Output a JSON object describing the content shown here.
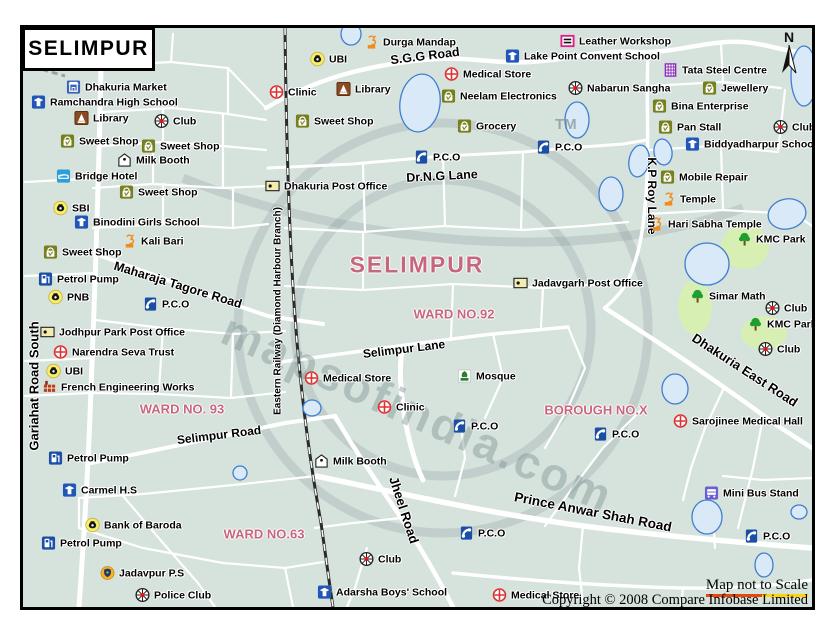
{
  "title": "SELIMPUR",
  "north_label": "N",
  "watermark": {
    "text": "mapsofindia.com",
    "tm": "TM"
  },
  "footer": {
    "scale_note": "Map not to Scale",
    "copyright": "Copyright © 2008 Compare Infobase Limited"
  },
  "colors": {
    "land": "#d6e2dc",
    "road": "#ffffff",
    "water_fill": "#d9e9f7",
    "water_stroke": "#3f7fd0",
    "park": "#d7efb2",
    "area_label": "#c7677e",
    "railway": "#2b2b2b"
  },
  "area_labels": [
    {
      "text": "SELIMPUR",
      "x": 394,
      "y": 237,
      "size": 23,
      "spacing": 2
    },
    {
      "text": "WARD NO.92",
      "x": 431,
      "y": 286,
      "size": 13,
      "spacing": 0
    },
    {
      "text": "WARD NO. 93",
      "x": 159,
      "y": 381,
      "size": 13,
      "spacing": 0
    },
    {
      "text": "WARD NO.63",
      "x": 241,
      "y": 506,
      "size": 13,
      "spacing": 0
    },
    {
      "text": "BOROUGH NO.X",
      "x": 573,
      "y": 382,
      "size": 13,
      "spacing": 0
    }
  ],
  "road_labels": [
    {
      "text": "S.G.G Road",
      "x": 402,
      "y": 28,
      "rot": -7,
      "size": 12.5
    },
    {
      "text": "Dr.N.G Lane",
      "x": 419,
      "y": 148,
      "rot": -3,
      "size": 12.5
    },
    {
      "text": "Maharaja Tagore Road",
      "x": 155,
      "y": 257,
      "rot": 17,
      "size": 12.5
    },
    {
      "text": "Selimpur Lane",
      "x": 381,
      "y": 321,
      "rot": -7,
      "size": 12
    },
    {
      "text": "Selimpur Road",
      "x": 196,
      "y": 407,
      "rot": -7,
      "size": 12
    },
    {
      "text": "Gariahat Road South",
      "x": 11,
      "y": 358,
      "rot": -90,
      "size": 13
    },
    {
      "text": "Eastern Railway (Diamond Harbour Branch)",
      "x": 255,
      "y": 283,
      "rot": -90,
      "size": 10
    },
    {
      "text": "K.P Roy Lane",
      "x": 629,
      "y": 168,
      "rot": 90,
      "size": 12
    },
    {
      "text": "Dhakuria East Road",
      "x": 722,
      "y": 342,
      "rot": 33,
      "size": 13
    },
    {
      "text": "Jheel Road",
      "x": 381,
      "y": 482,
      "rot": 72,
      "size": 13
    },
    {
      "text": "Prince Anwar Shah Road",
      "x": 570,
      "y": 484,
      "rot": 11,
      "size": 13.5
    }
  ],
  "pois": [
    {
      "label": "Dhakuria Market",
      "icon": "market",
      "x": 51,
      "y": 59
    },
    {
      "label": "Ramchandra High School",
      "icon": "school",
      "x": 16,
      "y": 74
    },
    {
      "label": "Library",
      "icon": "library",
      "x": 59,
      "y": 90
    },
    {
      "label": "Club",
      "icon": "club",
      "x": 139,
      "y": 93
    },
    {
      "label": "Sweet Shop",
      "icon": "shop",
      "x": 45,
      "y": 113
    },
    {
      "label": "Sweet Shop",
      "icon": "shop",
      "x": 126,
      "y": 118
    },
    {
      "label": "Milk Booth",
      "icon": "milk",
      "x": 102,
      "y": 132
    },
    {
      "label": "Bridge Hotel",
      "icon": "hotel",
      "x": 41,
      "y": 148
    },
    {
      "label": "Sweet Shop",
      "icon": "shop",
      "x": 104,
      "y": 164
    },
    {
      "label": "SBI",
      "icon": "bank",
      "x": 38,
      "y": 180
    },
    {
      "label": "Binodini Girls School",
      "icon": "school",
      "x": 59,
      "y": 194
    },
    {
      "label": "Kali Bari",
      "icon": "temple",
      "x": 107,
      "y": 213
    },
    {
      "label": "Sweet Shop",
      "icon": "shop",
      "x": 28,
      "y": 224
    },
    {
      "label": "Petrol Pump",
      "icon": "petrol",
      "x": 23,
      "y": 251
    },
    {
      "label": "PNB",
      "icon": "bank",
      "x": 33,
      "y": 269
    },
    {
      "label": "P.C.O",
      "icon": "pco",
      "x": 128,
      "y": 276
    },
    {
      "label": "Jodhpur Park Post Office",
      "icon": "post",
      "x": 25,
      "y": 304
    },
    {
      "label": "Narendra Seva Trust",
      "icon": "medical",
      "x": 38,
      "y": 324
    },
    {
      "label": "UBI",
      "icon": "bank",
      "x": 31,
      "y": 343
    },
    {
      "label": "French Engineering Works",
      "icon": "factory",
      "x": 27,
      "y": 359
    },
    {
      "label": "Petrol Pump",
      "icon": "petrol",
      "x": 33,
      "y": 430
    },
    {
      "label": "Carmel H.S",
      "icon": "school",
      "x": 47,
      "y": 462
    },
    {
      "label": "Bank of Baroda",
      "icon": "bank",
      "x": 70,
      "y": 497
    },
    {
      "label": "Petrol Pump",
      "icon": "petrol",
      "x": 26,
      "y": 515
    },
    {
      "label": "Jadavpur P.S",
      "icon": "police",
      "x": 85,
      "y": 545
    },
    {
      "label": "Police Club",
      "icon": "club",
      "x": 120,
      "y": 567
    },
    {
      "label": "Clinic",
      "icon": "medical",
      "x": 254,
      "y": 64
    },
    {
      "label": "Dhakuria Post Office",
      "icon": "post",
      "x": 250,
      "y": 158
    },
    {
      "label": "UBI",
      "icon": "bank",
      "x": 295,
      "y": 31
    },
    {
      "label": "Durga Mandap",
      "icon": "temple",
      "x": 349,
      "y": 14
    },
    {
      "label": "Library",
      "icon": "library",
      "x": 321,
      "y": 61
    },
    {
      "label": "Sweet Shop",
      "icon": "shop",
      "x": 280,
      "y": 93
    },
    {
      "label": "Medical Store",
      "icon": "medical",
      "x": 429,
      "y": 46
    },
    {
      "label": "Neelam Electronics",
      "icon": "shop",
      "x": 426,
      "y": 68
    },
    {
      "label": "Grocery",
      "icon": "shop",
      "x": 442,
      "y": 98
    },
    {
      "label": "P.C.O",
      "icon": "pco",
      "x": 399,
      "y": 129
    },
    {
      "label": "P.C.O",
      "icon": "pco",
      "x": 521,
      "y": 119
    },
    {
      "label": "Leather Workshop",
      "icon": "leather",
      "x": 545,
      "y": 13
    },
    {
      "label": "Lake Point Convent School",
      "icon": "school",
      "x": 490,
      "y": 28
    },
    {
      "label": "Tata Steel Centre",
      "icon": "steel",
      "x": 648,
      "y": 42
    },
    {
      "label": "Nabarun Sangha",
      "icon": "club",
      "x": 553,
      "y": 60
    },
    {
      "label": "Jewellery",
      "icon": "shop",
      "x": 687,
      "y": 60
    },
    {
      "label": "Bina Enterprise",
      "icon": "shop",
      "x": 637,
      "y": 78
    },
    {
      "label": "Pan Stall",
      "icon": "shop",
      "x": 643,
      "y": 99
    },
    {
      "label": "Club",
      "icon": "club",
      "x": 758,
      "y": 99
    },
    {
      "label": "Biddyadharpur School",
      "icon": "school",
      "x": 670,
      "y": 116
    },
    {
      "label": "Mobile Repair",
      "icon": "shop",
      "x": 645,
      "y": 149
    },
    {
      "label": "Temple",
      "icon": "temple",
      "x": 646,
      "y": 171
    },
    {
      "label": "Hari Sabha Temple",
      "icon": "temple",
      "x": 634,
      "y": 196
    },
    {
      "label": "KMC Park",
      "icon": "tree",
      "x": 722,
      "y": 211
    },
    {
      "label": "Jadavgarh Post Office",
      "icon": "post",
      "x": 498,
      "y": 255
    },
    {
      "label": "Simar Math",
      "icon": "tree",
      "x": 675,
      "y": 268
    },
    {
      "label": "Club",
      "icon": "club",
      "x": 750,
      "y": 280
    },
    {
      "label": "KMC Park",
      "icon": "tree",
      "x": 733,
      "y": 296
    },
    {
      "label": "Club",
      "icon": "club",
      "x": 743,
      "y": 321
    },
    {
      "label": "Medical Store",
      "icon": "medical",
      "x": 289,
      "y": 350
    },
    {
      "label": "Mosque",
      "icon": "mosque",
      "x": 442,
      "y": 348
    },
    {
      "label": "Clinic",
      "icon": "medical",
      "x": 362,
      "y": 379
    },
    {
      "label": "P.C.O",
      "icon": "pco",
      "x": 437,
      "y": 398
    },
    {
      "label": "P.C.O",
      "icon": "pco",
      "x": 578,
      "y": 406
    },
    {
      "label": "Sarojinee Medical Hall",
      "icon": "medical",
      "x": 658,
      "y": 393
    },
    {
      "label": "Milk Booth",
      "icon": "milk",
      "x": 299,
      "y": 433
    },
    {
      "label": "Mini Bus Stand",
      "icon": "bus",
      "x": 689,
      "y": 465
    },
    {
      "label": "P.C.O",
      "icon": "pco",
      "x": 444,
      "y": 505
    },
    {
      "label": "P.C.O",
      "icon": "pco",
      "x": 729,
      "y": 508
    },
    {
      "label": "Club",
      "icon": "club",
      "x": 344,
      "y": 531
    },
    {
      "label": "Adarsha Boys' School",
      "icon": "school",
      "x": 302,
      "y": 564
    },
    {
      "label": "Medical Store",
      "icon": "medical",
      "x": 477,
      "y": 567
    }
  ]
}
